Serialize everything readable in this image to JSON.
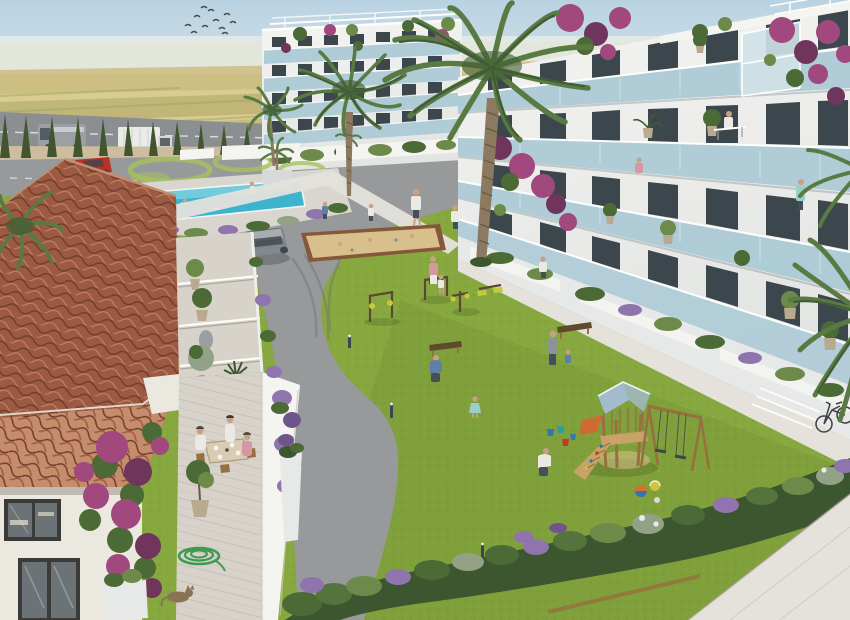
{
  "scene": {
    "title": "Aerial 3D render of a new-build Mediterranean apartment complex courtyard",
    "description": "Bright daylight aerial rendering: white multi-storey apartment buildings with glass balconies surround a large lawn with a timber playground, swings, petanque court and outdoor gym; a terracotta-roofed village house with a dining terrace sits in the left foreground; swimming pool, palm trees, cypress-lined road and farmland in the background.",
    "counts": {
      "birds": 11,
      "cypress_trees": 27,
      "vehicles": 4,
      "palm_trees": 6,
      "playground_swings": 2
    },
    "objects": {
      "vehicles": [
        "grey van on outer road",
        "white box truck on outer road",
        "red car on inner road",
        "grey SUV on driveway"
      ],
      "playground": [
        "timber tower with blue pitched roof",
        "climbing ramp with holds",
        "orange slide",
        "A-frame double swing",
        "beach balls",
        "toy buckets"
      ],
      "amenities": [
        "turquoise swimming pool",
        "petanque court",
        "outdoor gym equipment",
        "garden benches",
        "bollard lights",
        "bicycle"
      ],
      "house_terrace": [
        "family dining at table",
        "potted olive trees",
        "ceramic urns",
        "coiled garden hose",
        "sleeping cat",
        "bougainvillea vine"
      ],
      "people_on_lawn": [
        "woman with child",
        "crouching gardener",
        "man with toddler",
        "girl walking",
        "boy playing with buckets",
        "residents strolling"
      ]
    }
  },
  "palette": {
    "sky_top": "#b9d2e2",
    "sky_bottom": "#edf2f1",
    "haze": "#e4eae7",
    "field1": "#d9cc92",
    "field2": "#c9bb7d",
    "field3": "#b7ac6e",
    "field_row": "#9aa55f",
    "treeline": "#6f8054",
    "tree_dark": "#566844",
    "farm_wall": "#efece2",
    "farm_roof": "#a2624a",
    "wall": "#cdbd9e",
    "cypress": "#41552f",
    "road": "#8c8f92",
    "road_inner": "#97999b",
    "road_mark": "#eceeec",
    "lawn": "#86a83f",
    "lawn_light": "#a6c25c",
    "lawn_dark": "#74963a",
    "pool": "#3db4cc",
    "pool_light": "#8fd8e4",
    "deck": "#d9d6cf",
    "pavement": "#e4e2db",
    "building_white": "#f4f4f1",
    "building_shade": "#d7dad9",
    "building_shade2": "#e7e9e8",
    "window": "#3c474d",
    "glass": "#a9c9d5",
    "glass_hi": "#cfe2e8",
    "bougainvillea": "#a1487f",
    "bougainvillea_deep": "#70355c",
    "foliage": "#4c6a36",
    "foliage_light": "#6d8a4a",
    "foliage_dark": "#3c5630",
    "palm": "#5a7a44",
    "palm_dark": "#3f5c33",
    "trunk": "#8c7a60",
    "trunk_dark": "#695942",
    "roof": "#9d5a42",
    "roof_light": "#c68d6d",
    "roof_dark": "#6f3d2c",
    "house_wall": "#ebe8e0",
    "frame_dark": "#3a3a38",
    "pane": "#6b7377",
    "terrace": "#d7d3ca",
    "sand": "#d8bf8c",
    "sand_edge": "#85583a",
    "wood": "#c8a266",
    "wood_dark": "#96713f",
    "play_roof": "#a2bccd",
    "slide": "#cf6a33",
    "gym_frame": "#5c4730",
    "gym_accent": "#c5c93e",
    "bench": "#5f4a2f",
    "lavender": "#8f74ad",
    "lavender_dark": "#6e568c",
    "shrub": "#55743d",
    "shrub_gray": "#93a287",
    "car_red": "#bb3026",
    "van": "#9aa0a3",
    "truck": "#ebecea",
    "suv": "#83888c",
    "skin": "#c9a183",
    "cloth_white": "#ebe9e3",
    "cloth_dark": "#454f5c",
    "cloth_pink": "#d598a2",
    "cloth_blue": "#5e7fa8",
    "cloth_teal": "#9ccfc6",
    "cloth_gray": "#8d9496",
    "bucket_blue": "#2e76b5",
    "bucket_red": "#c23a2c",
    "bucket_teal": "#2f9e98",
    "ball_orange": "#d96f2e",
    "ball_yellow": "#d2c23c",
    "hose": "#3e9a4e",
    "cat": "#8a7355",
    "pot": "#b8a98f",
    "urn": "#a89c8a",
    "statue": "#9aa0a2",
    "bird": "#4a4a48"
  }
}
